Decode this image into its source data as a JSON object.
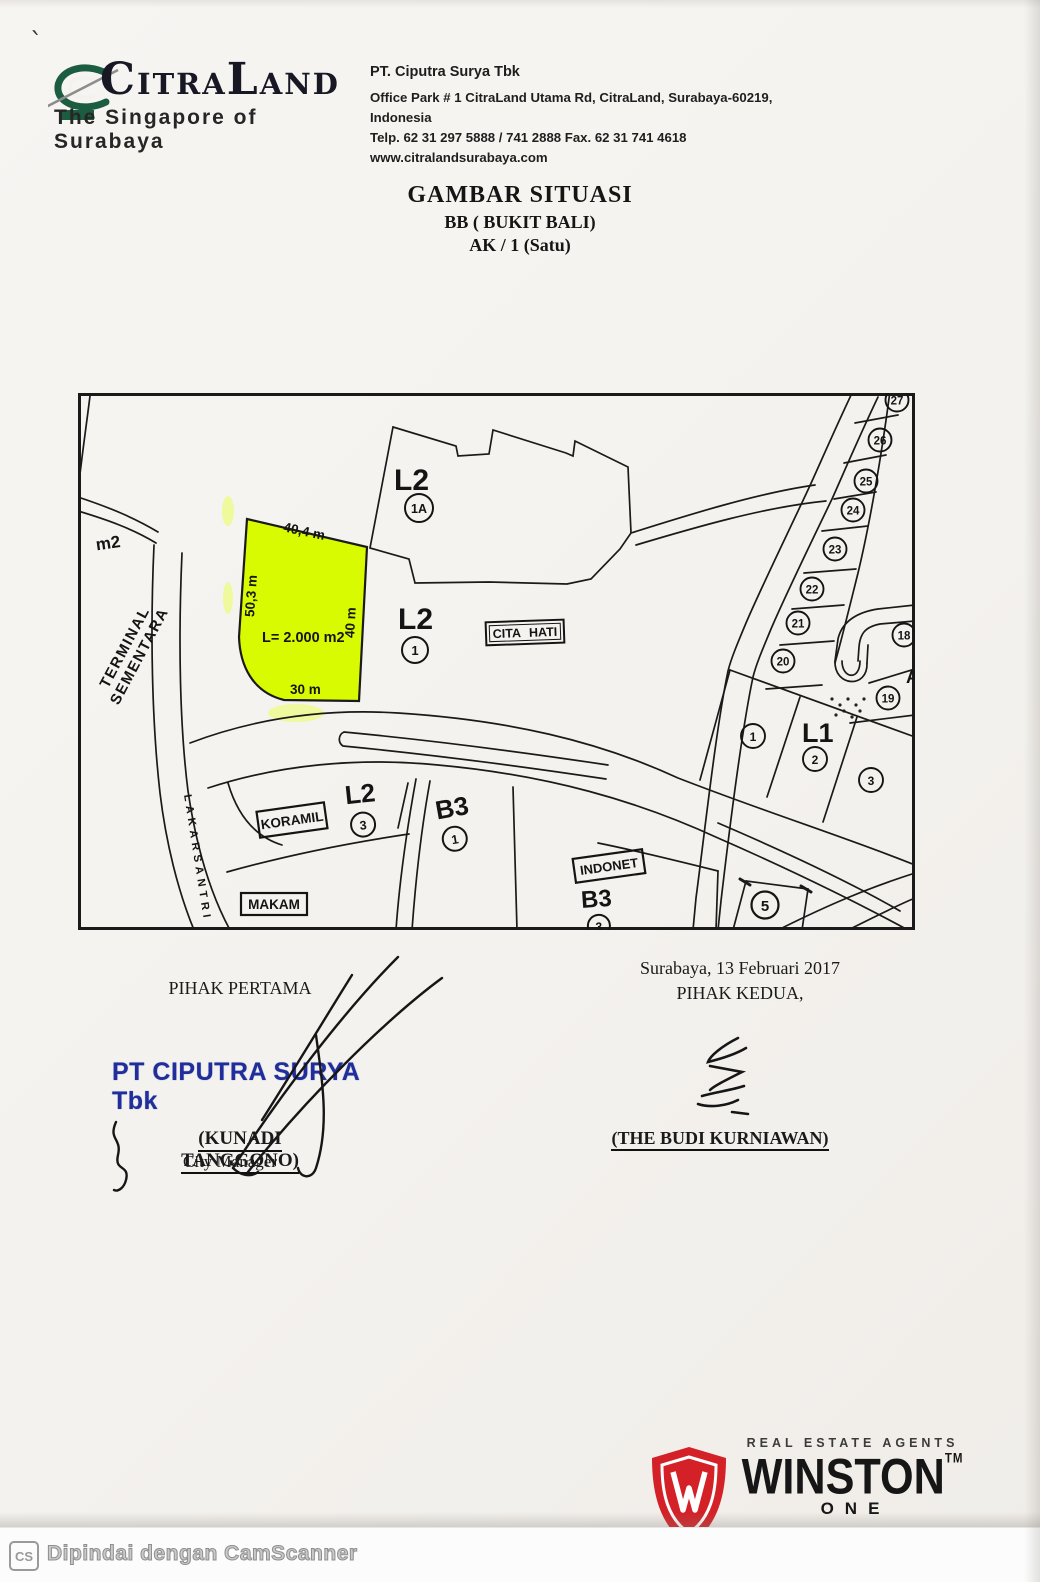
{
  "header": {
    "brand": {
      "c1": "C",
      "m1": "ITRA",
      "c2": "L",
      "m2": "AND",
      "tagline": "The Singapore of Surabaya"
    },
    "company": {
      "name": "PT. Ciputra Surya Tbk",
      "address": "Office Park # 1 CitraLand Utama Rd, CitraLand, Surabaya-60219, Indonesia",
      "phones": "Telp. 62 31 297 5888 / 741 2888  Fax. 62 31 741 4618",
      "website": "www.citralandsurabaya.com"
    }
  },
  "title": {
    "line1": "GAMBAR SITUASI",
    "line2": "BB ( BUKIT BALI)",
    "line3": "AK / 1 (Satu)"
  },
  "map": {
    "highlight_color": "#d9fb02",
    "m2_label": "m2",
    "terminal_line1": "TERMINAL",
    "terminal_line2": "SEMENTARA",
    "road_label": "LAKARSANTRI",
    "plot": {
      "dim_top": "40,4 m",
      "dim_left": "50,3 m",
      "dim_right": "40 m",
      "dim_bottom": "30 m",
      "area": "L= 2.000 m2"
    },
    "boxes": {
      "cita_hati": "CITA HATI",
      "koramil": "KORAMIL",
      "makam": "MAKAM",
      "indonet": "INDONET"
    },
    "blocks": {
      "l2_1a": {
        "code": "L2",
        "num": "1A"
      },
      "l2_1": {
        "code": "L2",
        "num": "1"
      },
      "l2_3": {
        "code": "L2",
        "num": "3"
      },
      "b3_1": {
        "code": "B3",
        "num": "1"
      },
      "b3_3": {
        "code": "B3",
        "num": "3"
      },
      "l1": {
        "code": "L1",
        "nums": [
          "1",
          "2",
          "3"
        ]
      },
      "plot5": "5"
    },
    "right_plots": [
      "27",
      "26",
      "25",
      "24",
      "23",
      "22",
      "21",
      "20"
    ],
    "side_plots": [
      "18",
      "19"
    ],
    "edge_letter": "A"
  },
  "signatures": {
    "left": {
      "heading": "PIHAK PERTAMA",
      "stamp": "PT CIPUTRA SURYA Tbk",
      "stamp_color": "#202e9c",
      "name": "(KUNADI TANGGONO)",
      "role": "City Manager"
    },
    "right": {
      "place_date": "Surabaya,  13 Februari 2017",
      "heading": "PIHAK KEDUA,",
      "name": "(THE BUDI KURNIAWAN)"
    }
  },
  "footer_logo": {
    "tagline": "REAL ESTATE AGENTS",
    "name": "WINSTON",
    "tm": "TM",
    "sub": "ONE",
    "shield_color": "#d32127"
  },
  "scanner_bar": {
    "icon": "CS",
    "text": "Dipindai dengan CamScanner"
  }
}
